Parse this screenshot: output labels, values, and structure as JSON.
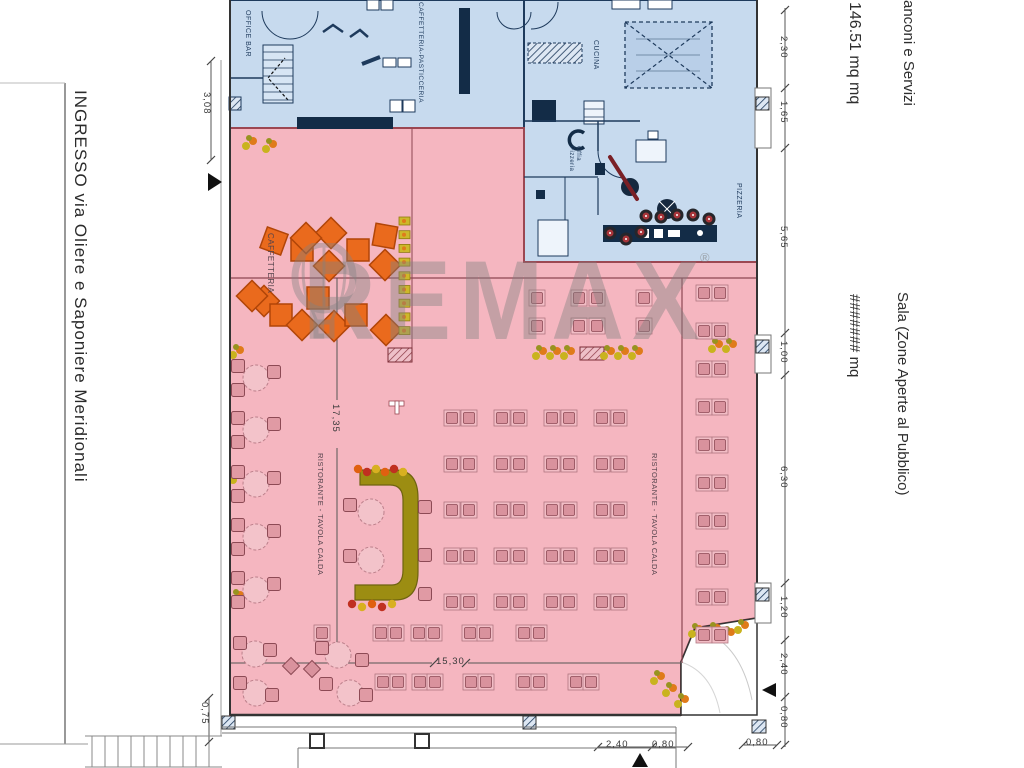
{
  "side_annotations": {
    "street": "INGRESSO via Oliere e Saponiere Meridionali",
    "zone_services_name": "anconi e Servizi",
    "zone_services_area": "146.51 mq mq",
    "zone_hall_name": "Sala (Zone Aperte al Pubblico)",
    "zone_hall_area": "####### mq"
  },
  "room_labels": {
    "office_bar": "OFFICE BAR",
    "caffetteria_pasticceria": "CAFFETTERIA-PASTICCERIA",
    "cucina": "CUCINA",
    "off_pizzeria": "Offia Pizzeria",
    "pizzeria": "PIZZERIA",
    "caffetteria": "CAFFETTERIA",
    "ristorante_left": "RISTORANTE - TAVOLA CALDA",
    "ristorante_right": "RISTORANTE - TAVOLA CALDA"
  },
  "dimensions": {
    "right_chain": [
      "2,30",
      "1,65",
      "5,65",
      "1,00",
      "6,30",
      "1,20",
      "2,40",
      "0,80"
    ],
    "left_top": "3,08",
    "left_bottom": "0,75",
    "hall_height": "17,35",
    "hall_width": "15,30",
    "bottom_a": "2,40",
    "bottom_b": "0,80",
    "bottom_right": "0,80"
  },
  "watermark": {
    "brand": "REMAX",
    "registered": "®"
  },
  "colors": {
    "blue_room": "#c7daee",
    "blue_wall": "#1e3a5c",
    "pink_room": "#f5b6c0",
    "pink_wall": "#9c4752",
    "orange_table": "#ea6a1d",
    "counter_olive": "#9c8d12",
    "watermark_grey": "#828282"
  }
}
